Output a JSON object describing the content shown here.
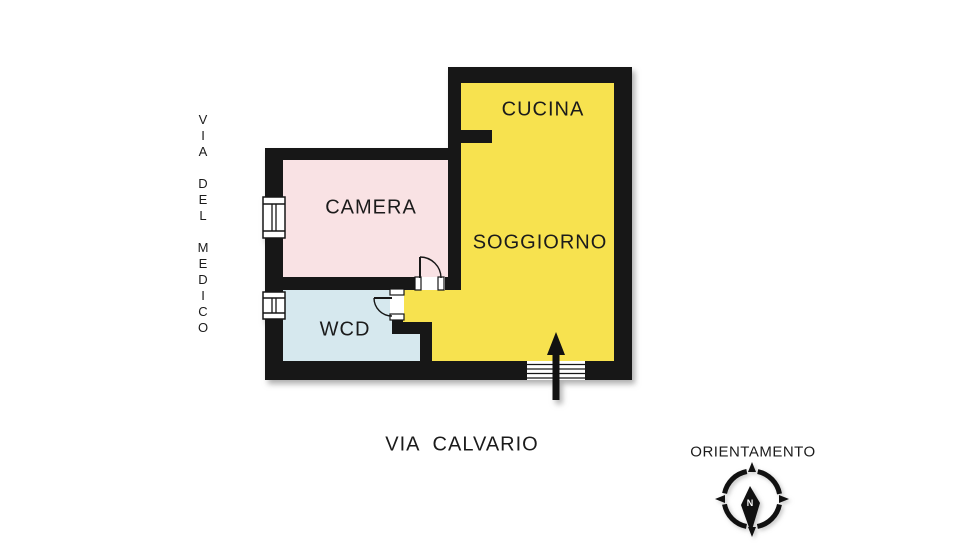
{
  "rooms": {
    "cucina": {
      "label": "CUCINA",
      "color": "#f7e24f"
    },
    "soggiorno": {
      "label": "SOGGIORNO",
      "color": "#f7e24f"
    },
    "camera": {
      "label": "CAMERA",
      "color": "#f9e2e4"
    },
    "wcd": {
      "label": "WCD",
      "color": "#d6e8ee"
    }
  },
  "streets": {
    "left": "VIA DEL MEDICO",
    "bottom": "VIA  CALVARIO"
  },
  "compass": {
    "title": "ORIENTAMENTO",
    "needle_label": "N"
  },
  "icons": {
    "entrance_arrow": "up-arrow",
    "compass_rose": "compass-rose",
    "windows": "double-line-window-symbol",
    "doors": "quarter-arc-door-symbol"
  },
  "colors": {
    "wall": "#171717",
    "ink": "#111111",
    "window": "#ffffff",
    "label_text": "#1b1b1b",
    "background": "#ffffff"
  }
}
